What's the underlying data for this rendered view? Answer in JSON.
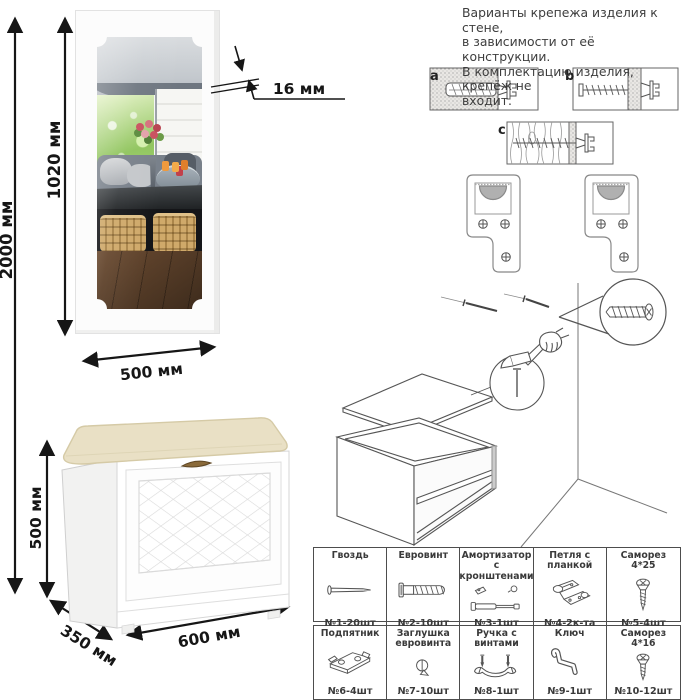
{
  "dimensions": {
    "total_height": "2000 мм",
    "mirror_height": "1020 мм",
    "mirror_width": "500 мм",
    "panel_thickness": "16 мм",
    "bench_height": "500 мм",
    "bench_depth": "350 мм",
    "bench_width": "600 мм"
  },
  "wall_mount": {
    "note": "Варианты крепежа изделия к стене,\nв зависимости от её конструкции.\nВ комплектацию изделия, крепёж не\nвходит.",
    "label_a": "a",
    "label_b": "b",
    "label_c": "c"
  },
  "hardware": {
    "items": [
      {
        "name": "Гвоздь",
        "count": "№1-20шт",
        "icon": "nail-icon"
      },
      {
        "name": "Евровинт",
        "count": "№2-10шт",
        "icon": "euro-screw-icon"
      },
      {
        "name": "Амортизатор с кронштенами",
        "count": "№3-1шт",
        "icon": "gas-strut-icon"
      },
      {
        "name": "Петля с планкой",
        "count": "№4-2к-та",
        "icon": "hinge-icon"
      },
      {
        "name": "Саморез 4*25",
        "count": "№5-4шт",
        "icon": "long-screw-icon"
      },
      {
        "name": "Подпятник",
        "count": "№6-4шт",
        "icon": "footplate-icon"
      },
      {
        "name": "Заглушка евровинта",
        "count": "№7-10шт",
        "icon": "cap-icon"
      },
      {
        "name": "Ручка с винтами",
        "count": "№8-1шт",
        "icon": "handle-icon"
      },
      {
        "name": "Ключ",
        "count": "№9-1шт",
        "icon": "hex-key-icon"
      },
      {
        "name": "Саморез 4*16",
        "count": "№10-12шт",
        "icon": "short-screw-icon"
      }
    ]
  },
  "colors": {
    "line_art": "#555555",
    "dimension": "#161616",
    "cushion": "#e9e0c5",
    "bracket_slot": "#b0b0b0",
    "table_border": "#4d4d4d"
  }
}
